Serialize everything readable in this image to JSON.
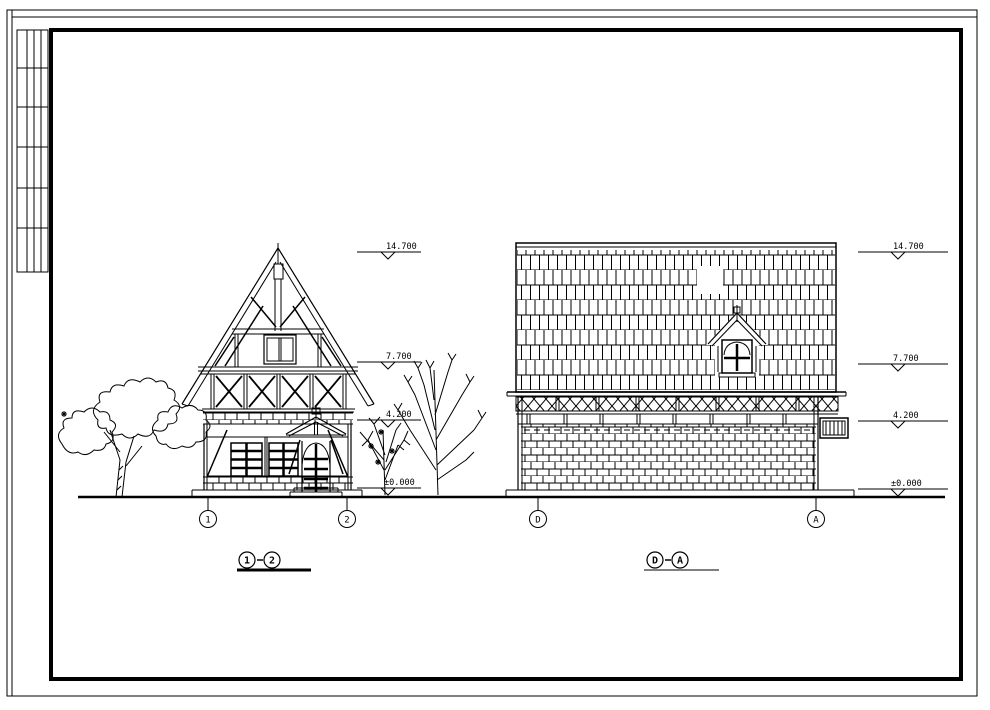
{
  "sheet": {
    "background": "#ffffff",
    "line_color": "#000000"
  },
  "left_elevation": {
    "title": {
      "a": "1",
      "b": "2"
    },
    "axes": [
      {
        "label": "1"
      },
      {
        "label": "2"
      }
    ],
    "levels": [
      {
        "value": "14.700"
      },
      {
        "value": "7.700"
      },
      {
        "value": "4.200"
      },
      {
        "value": "±0.000"
      }
    ]
  },
  "right_elevation": {
    "title": {
      "a": "D",
      "b": "A"
    },
    "axes": [
      {
        "label": "D"
      },
      {
        "label": "A"
      }
    ],
    "levels": [
      {
        "value": "14.700"
      },
      {
        "value": "7.700"
      },
      {
        "value": "4.200"
      },
      {
        "value": "±0.000"
      }
    ]
  }
}
